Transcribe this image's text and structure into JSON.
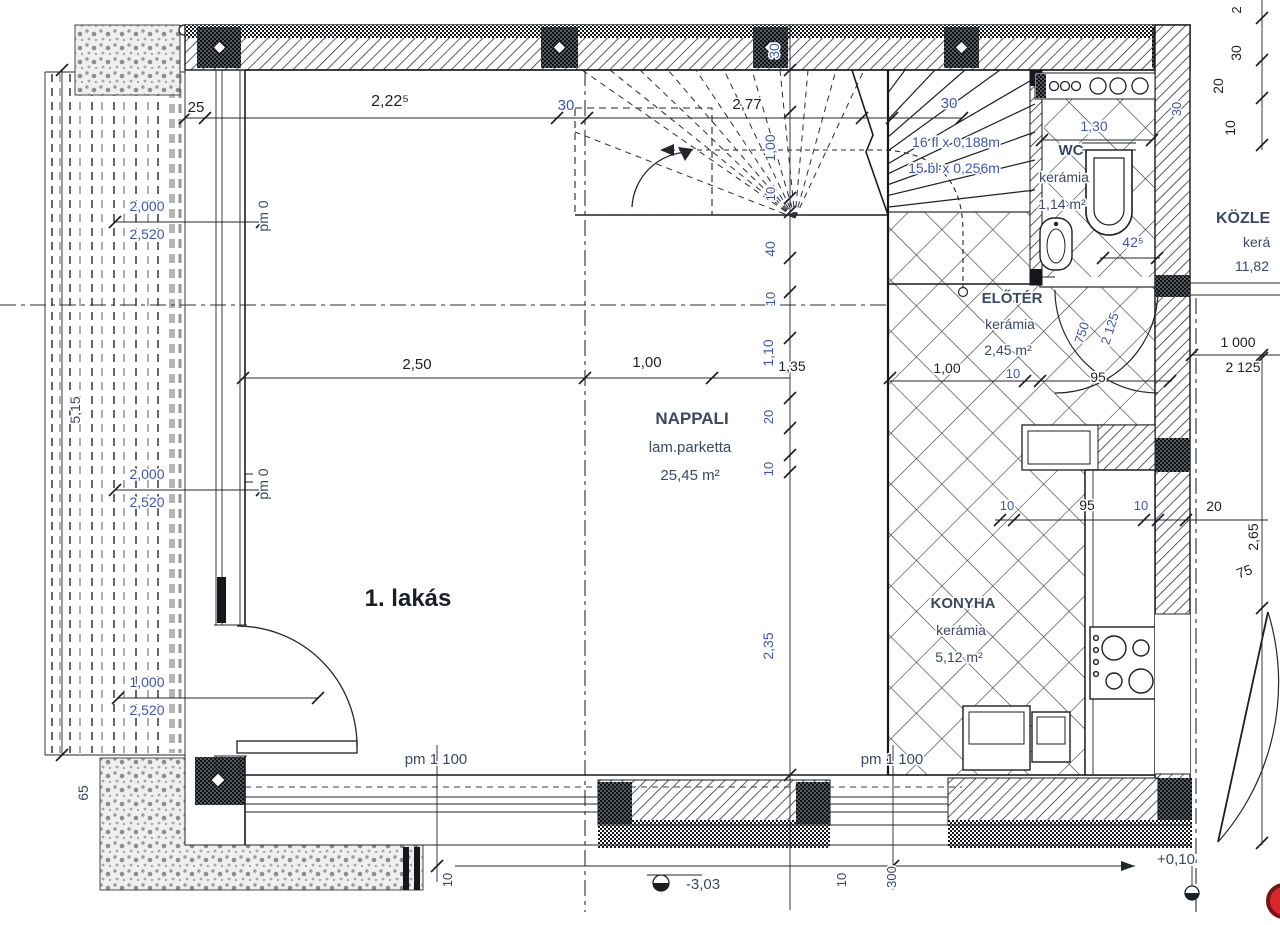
{
  "palette": {
    "ink": "#1b2026",
    "blue": "#3f57ad",
    "navy": "#3a4765",
    "red": "#d7282a"
  },
  "drawing_title": "1. lakás floor plan",
  "labels": [
    {
      "id": "dim-top-25",
      "t": "25",
      "x": 196,
      "y": 112,
      "s": 15,
      "c": "ink"
    },
    {
      "id": "dim-top-2-22-5",
      "t": "2,22⁵",
      "x": 390,
      "y": 106,
      "s": 16,
      "c": "ink"
    },
    {
      "id": "dim-top-30-left",
      "t": "30",
      "x": 566,
      "y": 110,
      "s": 15,
      "c": "blue"
    },
    {
      "id": "dim-top-2-77",
      "t": "2,77",
      "x": 747,
      "y": 109,
      "s": 15,
      "c": "ink"
    },
    {
      "id": "dim-top-30-right",
      "t": "30",
      "x": 949,
      "y": 108,
      "s": 15,
      "c": "blue"
    },
    {
      "id": "dim-wc-1-30",
      "t": "1,30",
      "x": 1094,
      "y": 131,
      "s": 14,
      "c": "blue"
    },
    {
      "id": "room-wc-name",
      "t": "WC",
      "x": 1071,
      "y": 155,
      "s": 15,
      "c": "navy",
      "w": 700
    },
    {
      "id": "room-wc-finish",
      "t": "kerámia",
      "x": 1064,
      "y": 182,
      "s": 14,
      "c": "navy"
    },
    {
      "id": "room-wc-area",
      "t": "1,14 m²",
      "x": 1062,
      "y": 209,
      "s": 14,
      "c": "navy"
    },
    {
      "id": "stair-risers",
      "t": "16 fl x 0,188m",
      "x": 956,
      "y": 147,
      "s": 14,
      "c": "blue"
    },
    {
      "id": "stair-treads",
      "t": "15 bl x 0,256m",
      "x": 954,
      "y": 173,
      "s": 14,
      "c": "blue"
    },
    {
      "id": "room-kozlekedo-name",
      "t": "KÖZLE",
      "x": 1216,
      "y": 223,
      "s": 16,
      "c": "navy",
      "w": 700,
      "a": "start"
    },
    {
      "id": "room-kozlekedo-finish",
      "t": "kerá",
      "x": 1243,
      "y": 247,
      "s": 14,
      "c": "navy",
      "a": "start"
    },
    {
      "id": "room-kozlekedo-area",
      "t": "11,82",
      "x": 1235,
      "y": 271,
      "s": 14,
      "c": "navy",
      "a": "start"
    },
    {
      "id": "dim-wc-42-5",
      "t": "42⁵",
      "x": 1133,
      "y": 247,
      "s": 14,
      "c": "blue"
    },
    {
      "id": "chain-30-wall",
      "t": "30",
      "x": 779,
      "y": 51,
      "r": -90,
      "s": 14,
      "c": "blue"
    },
    {
      "id": "chain-1-00",
      "t": "1,00",
      "x": 775,
      "y": 148,
      "r": -90,
      "s": 14,
      "c": "blue"
    },
    {
      "id": "chain-10-a",
      "t": "10",
      "x": 775,
      "y": 194,
      "r": -90,
      "s": 13,
      "c": "blue"
    },
    {
      "id": "chain-40",
      "t": "40",
      "x": 775,
      "y": 249,
      "r": -90,
      "s": 14,
      "c": "blue"
    },
    {
      "id": "chain-10-b",
      "t": "10",
      "x": 775,
      "y": 299,
      "r": -90,
      "s": 13,
      "c": "blue"
    },
    {
      "id": "chain-1-10",
      "t": "1,10",
      "x": 773,
      "y": 353,
      "r": -90,
      "s": 14,
      "c": "blue"
    },
    {
      "id": "dim-1-35",
      "t": "1,35",
      "x": 792,
      "y": 371,
      "s": 14,
      "c": "ink"
    },
    {
      "id": "chain-20",
      "t": "20",
      "x": 773,
      "y": 417,
      "r": -90,
      "s": 13,
      "c": "blue"
    },
    {
      "id": "chain-10-c",
      "t": "10",
      "x": 773,
      "y": 469,
      "r": -90,
      "s": 13,
      "c": "blue"
    },
    {
      "id": "chain-2-35",
      "t": "2,35",
      "x": 773,
      "y": 646,
      "r": -90,
      "s": 14,
      "c": "blue"
    },
    {
      "id": "dim-mid-2-50",
      "t": "2,50",
      "x": 417,
      "y": 369,
      "s": 15,
      "c": "ink"
    },
    {
      "id": "dim-mid-1-00",
      "t": "1,00",
      "x": 647,
      "y": 367,
      "s": 15,
      "c": "ink"
    },
    {
      "id": "room-eloter-name",
      "t": "ELŐTÉR",
      "x": 1012,
      "y": 303,
      "s": 15,
      "c": "navy",
      "w": 700
    },
    {
      "id": "room-eloter-finish",
      "t": "kerámia",
      "x": 1010,
      "y": 329,
      "s": 14,
      "c": "navy"
    },
    {
      "id": "room-eloter-area",
      "t": "2,45 m²",
      "x": 1008,
      "y": 355,
      "s": 14,
      "c": "navy"
    },
    {
      "id": "dim-el-1-00",
      "t": "1,00",
      "x": 947,
      "y": 373,
      "s": 14,
      "c": "ink"
    },
    {
      "id": "dim-el-10",
      "t": "10",
      "x": 1013,
      "y": 378,
      "s": 13,
      "c": "blue"
    },
    {
      "id": "dim-el-95",
      "t": "95",
      "x": 1098,
      "y": 382,
      "s": 14,
      "c": "ink"
    },
    {
      "id": "door-wc-750",
      "t": "750",
      "x": 1086,
      "y": 334,
      "r": -72,
      "s": 13,
      "c": "blue"
    },
    {
      "id": "door-wc-2125",
      "t": "2 125",
      "x": 1114,
      "y": 330,
      "r": -72,
      "s": 13,
      "c": "blue"
    },
    {
      "id": "room-nappali-name",
      "t": "NAPPALI",
      "x": 692,
      "y": 424,
      "s": 17,
      "c": "navy",
      "w": 700
    },
    {
      "id": "room-nappali-finish",
      "t": "lam.parketta",
      "x": 690,
      "y": 452,
      "s": 15,
      "c": "navy"
    },
    {
      "id": "room-nappali-area",
      "t": "25,45 m²",
      "x": 690,
      "y": 480,
      "s": 15,
      "c": "navy"
    },
    {
      "id": "dim-right-1000",
      "t": "1 000",
      "x": 1238,
      "y": 347,
      "s": 14,
      "c": "ink"
    },
    {
      "id": "dim-right-2125",
      "t": "2 125",
      "x": 1243,
      "y": 372,
      "s": 14,
      "c": "ink"
    },
    {
      "id": "dim-k-10-a",
      "t": "10",
      "x": 1007,
      "y": 510,
      "s": 13,
      "c": "blue"
    },
    {
      "id": "dim-k-95",
      "t": "95",
      "x": 1087,
      "y": 510,
      "s": 14,
      "c": "ink"
    },
    {
      "id": "dim-k-10-b",
      "t": "10",
      "x": 1141,
      "y": 510,
      "s": 13,
      "c": "blue"
    },
    {
      "id": "dim-k-20",
      "t": "20",
      "x": 1214,
      "y": 511,
      "s": 14,
      "c": "ink"
    },
    {
      "id": "dim-right-2-65",
      "t": "2,65",
      "x": 1258,
      "y": 537,
      "r": -90,
      "s": 14,
      "c": "ink"
    },
    {
      "id": "dim-right-75",
      "t": "75",
      "x": 1246,
      "y": 576,
      "r": -20,
      "s": 14,
      "c": "ink"
    },
    {
      "id": "left-2000-a",
      "t": "2,000",
      "x": 147,
      "y": 211,
      "s": 14,
      "c": "blue"
    },
    {
      "id": "left-2520-a",
      "t": "2,520",
      "x": 147,
      "y": 239,
      "s": 14,
      "c": "blue"
    },
    {
      "id": "left-pm0-a",
      "t": "pm 0",
      "x": 268,
      "y": 216,
      "r": -90,
      "s": 14,
      "c": "navy"
    },
    {
      "id": "left-5-15",
      "t": "5,15",
      "x": 80,
      "y": 410,
      "r": -90,
      "s": 14,
      "c": "navy"
    },
    {
      "id": "left-2000-b",
      "t": "2,000",
      "x": 147,
      "y": 479,
      "s": 14,
      "c": "blue"
    },
    {
      "id": "left-2520-b",
      "t": "2,520",
      "x": 147,
      "y": 507,
      "s": 14,
      "c": "blue"
    },
    {
      "id": "left-pm0-b",
      "t": "pm 0",
      "x": 268,
      "y": 484,
      "r": -90,
      "s": 14,
      "c": "navy"
    },
    {
      "id": "left-1000",
      "t": "1,000",
      "x": 147,
      "y": 687,
      "s": 14,
      "c": "blue"
    },
    {
      "id": "left-2520-c",
      "t": "2,520",
      "x": 147,
      "y": 715,
      "s": 14,
      "c": "blue"
    },
    {
      "id": "left-65",
      "t": "65",
      "x": 88,
      "y": 793,
      "r": -90,
      "s": 14,
      "c": "navy"
    },
    {
      "id": "room-lakas",
      "t": "1. lakás",
      "x": 408,
      "y": 606,
      "s": 24,
      "c": "ink",
      "w": 700
    },
    {
      "id": "room-konyha-name",
      "t": "KONYHA",
      "x": 963,
      "y": 608,
      "s": 15,
      "c": "navy",
      "w": 700
    },
    {
      "id": "room-konyha-finish",
      "t": "kerámia",
      "x": 961,
      "y": 635,
      "s": 14,
      "c": "navy"
    },
    {
      "id": "room-konyha-area",
      "t": "5,12 m²",
      "x": 959,
      "y": 662,
      "s": 14,
      "c": "navy"
    },
    {
      "id": "pm-1100-left",
      "t": "pm 1 100",
      "x": 436,
      "y": 764,
      "s": 15,
      "c": "navy"
    },
    {
      "id": "pm-1100-right",
      "t": "pm 1 100",
      "x": 892,
      "y": 764,
      "s": 15,
      "c": "navy"
    },
    {
      "id": "bot-10-left",
      "t": "10",
      "x": 452,
      "y": 880,
      "r": -90,
      "s": 13,
      "c": "navy"
    },
    {
      "id": "bot-10-right",
      "t": "10",
      "x": 846,
      "y": 880,
      "r": -90,
      "s": 13,
      "c": "navy"
    },
    {
      "id": "bot-300",
      "t": "300",
      "x": 896,
      "y": 877,
      "r": -90,
      "s": 13,
      "c": "navy"
    },
    {
      "id": "level-minus-3-03",
      "t": "-3,03",
      "x": 703,
      "y": 889,
      "s": 15,
      "c": "navy"
    },
    {
      "id": "level-plus-0-10",
      "t": "+0,10",
      "x": 1176,
      "y": 864,
      "s": 15,
      "c": "navy"
    },
    {
      "id": "tr-2",
      "t": "2",
      "x": 1241,
      "y": 10,
      "r": -90,
      "s": 13,
      "c": "ink"
    },
    {
      "id": "tr-30-a",
      "t": "30",
      "x": 1241,
      "y": 53,
      "r": -90,
      "s": 14,
      "c": "ink"
    },
    {
      "id": "tr-20",
      "t": "20",
      "x": 1223,
      "y": 86,
      "r": -90,
      "s": 14,
      "c": "ink"
    },
    {
      "id": "tr-10",
      "t": "10",
      "x": 1235,
      "y": 128,
      "r": -90,
      "s": 14,
      "c": "ink"
    },
    {
      "id": "tr-30-b",
      "t": "30",
      "x": 1181,
      "y": 109,
      "r": -90,
      "s": 13,
      "c": "blue"
    }
  ]
}
